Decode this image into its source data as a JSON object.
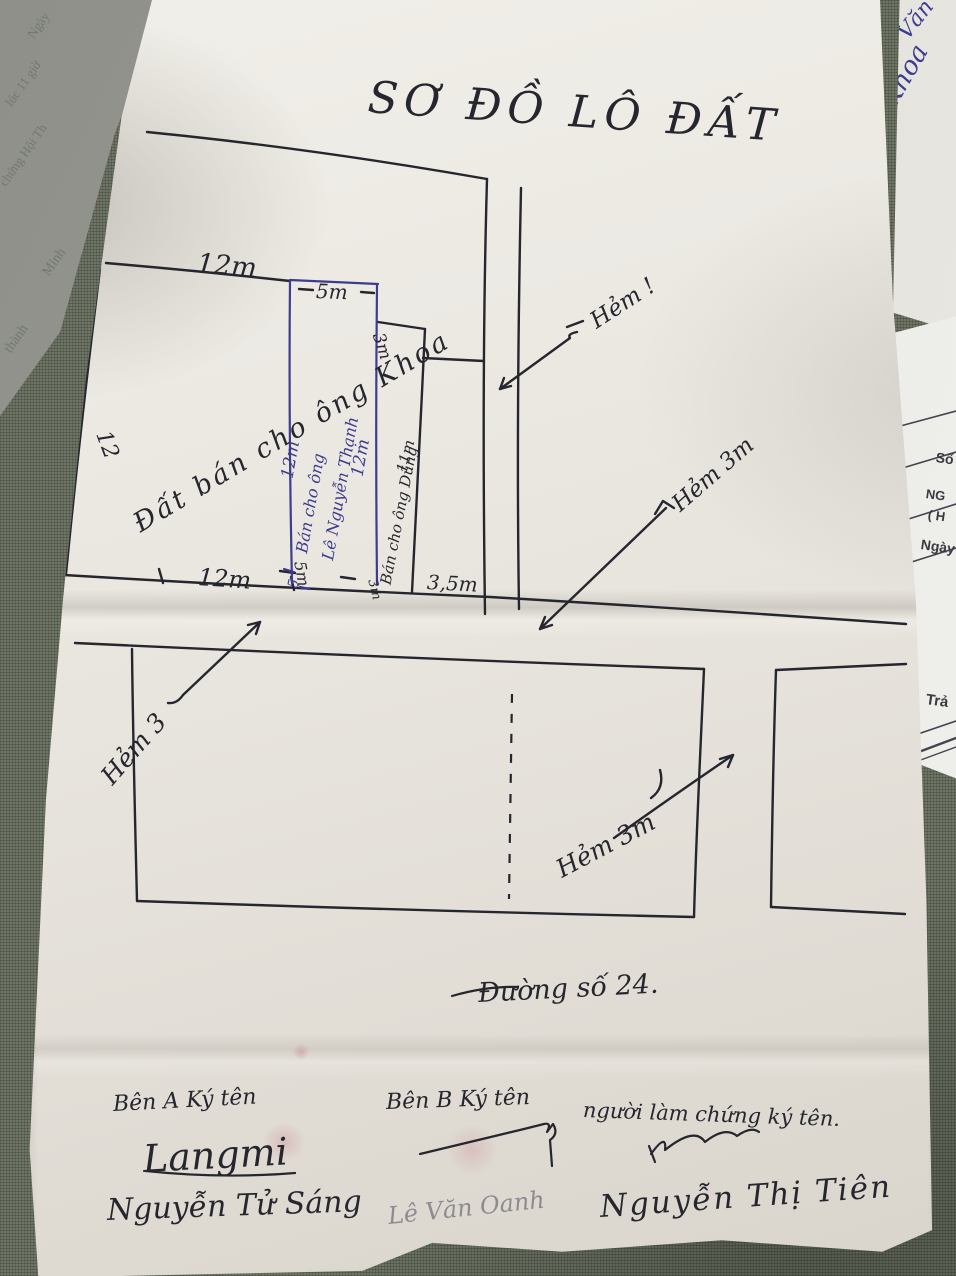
{
  "document": {
    "title": "SƠ ĐỒ LÔ ĐẤT",
    "plot_upper": {
      "width_top": "12m",
      "width_5m": "5m",
      "step_width": "3m",
      "depth_left": "12",
      "note_khoa": "Đất bán cho ông Khoa",
      "strip_blue": {
        "depth_a": "12m",
        "text_1": "Bán cho ông",
        "text_2": "Lê Nguyễn Thạnh",
        "depth_b": "12m",
        "tick": "5"
      },
      "strip_dung": {
        "text": "Bán cho ông Dũng",
        "depth": "11m"
      },
      "width_bottom_1": "12m",
      "width_bottom_2": "5m",
      "width_bottom_3": "3m",
      "width_bottom_4": "3,5m"
    },
    "alleys": {
      "top": "Hẻm !",
      "right": "Hẻm 3m",
      "left": "Hẻm 3",
      "lower": "Hẻm 3m"
    },
    "street": "Đường số 24.",
    "signing": {
      "party_a_label": "Bên A Ký tên",
      "party_a_signature": "Langmi",
      "party_a_name": "Nguyễn Tử Sáng",
      "party_b_label": "Bên B Ký tên",
      "party_b_name": "Lê Văn Oanh",
      "witness_label": "người làm chứng ký tên.",
      "witness_name": "Nguyễn Thị Tiên"
    }
  },
  "background_papers": {
    "note_blue_1": "Văn",
    "note_blue_2": "Khoa",
    "faint_1": "Ngày",
    "faint_2": "lúc 11 giờ",
    "faint_3": "chứng Hội Th",
    "faint_4": "Minh",
    "faint_5": "thành",
    "form_1": "Số",
    "form_2": "NG",
    "form_3": "( H",
    "form_4": "Ngày",
    "form_5": "Trả"
  },
  "colors": {
    "ink_black": "#26262e",
    "ink_blue": "#3d3c8f",
    "pencil_gray": "#6f6c78",
    "paper_white": "#eae7e0",
    "table_green": "#6e7565"
  }
}
